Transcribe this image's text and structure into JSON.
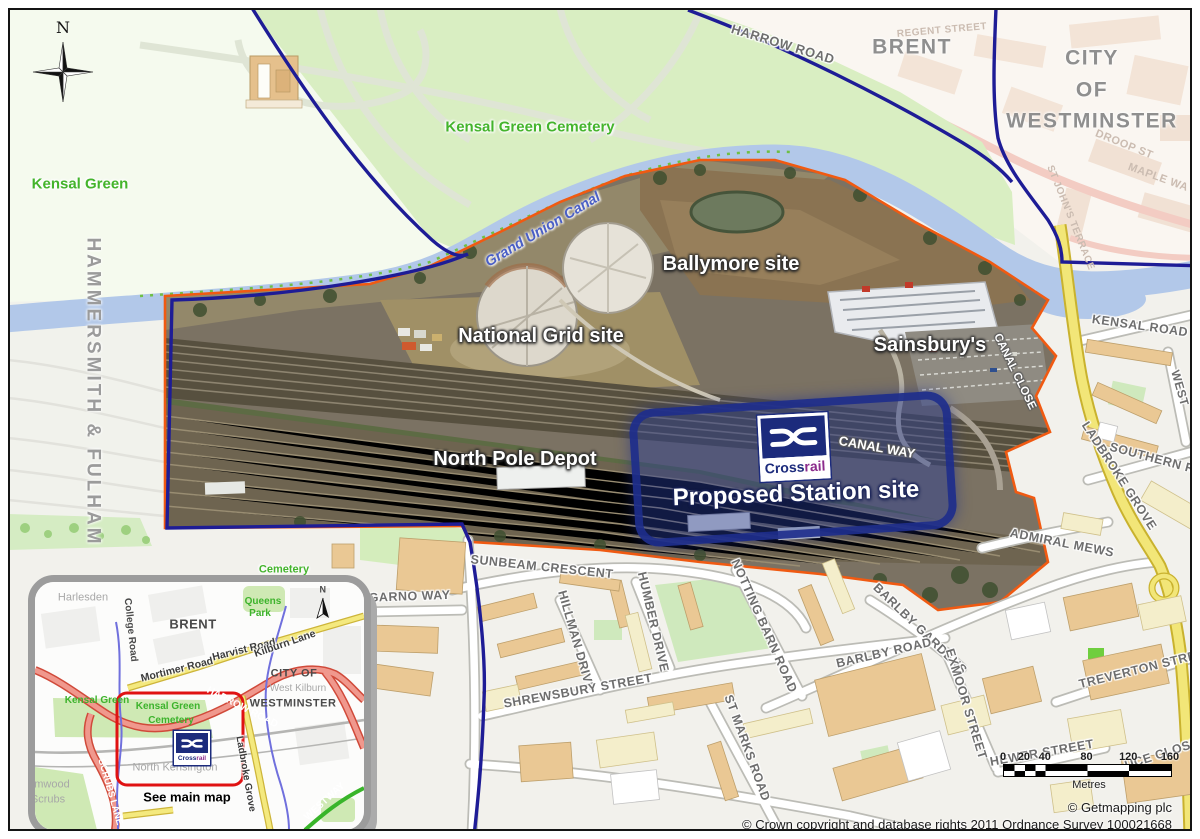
{
  "map": {
    "north_indicator": "N",
    "overlay": {
      "title": "Proposed Station site",
      "road": "CANAL WAY",
      "logo_text_1": "Cross",
      "logo_text_2": "rail"
    },
    "labels": [
      {
        "id": "kensal-green",
        "t": "Kensal Green",
        "x": 80,
        "y": 184,
        "r": 0,
        "s": 15,
        "c": "green"
      },
      {
        "id": "hammersmith-fulham",
        "t": "HAMMERSMITH & FULHAM",
        "x": 93,
        "y": 392,
        "r": 90,
        "s": 19,
        "c": "borough sp"
      },
      {
        "id": "kensal-green-cemetery",
        "t": "Kensal Green Cemetery",
        "x": 530,
        "y": 127,
        "r": 0,
        "s": 15,
        "c": "green"
      },
      {
        "id": "grand-union-canal",
        "t": "Grand Union Canal",
        "x": 543,
        "y": 230,
        "r": -31,
        "s": 14.5,
        "c": "canal"
      },
      {
        "id": "harrow-road",
        "t": "HARROW ROAD",
        "x": 783,
        "y": 44,
        "r": 17,
        "s": 13,
        "c": "street"
      },
      {
        "id": "brent",
        "t": "BRENT",
        "x": 912,
        "y": 47,
        "r": 0,
        "s": 21,
        "c": "borough"
      },
      {
        "id": "regent-street",
        "t": "REGENT STREET",
        "x": 942,
        "y": 31,
        "r": -5,
        "s": 10,
        "c": "faint"
      },
      {
        "id": "city",
        "t": "CITY",
        "x": 1092,
        "y": 58,
        "r": 0,
        "s": 21,
        "c": "borough"
      },
      {
        "id": "of",
        "t": "OF",
        "x": 1092,
        "y": 90,
        "r": 0,
        "s": 21,
        "c": "borough"
      },
      {
        "id": "westminster",
        "t": "WESTMINSTER",
        "x": 1092,
        "y": 121,
        "r": 0,
        "s": 21,
        "c": "borough"
      },
      {
        "id": "droop-st",
        "t": "DROOP ST",
        "x": 1124,
        "y": 145,
        "r": 22,
        "s": 11,
        "c": "faint"
      },
      {
        "id": "maple-wa",
        "t": "MAPLE WA",
        "x": 1158,
        "y": 178,
        "r": 20,
        "s": 11,
        "c": "faint"
      },
      {
        "id": "st-johns-terrace",
        "t": "ST JOHN'S TERRACE",
        "x": 1070,
        "y": 218,
        "r": 68,
        "s": 10,
        "c": "faint"
      },
      {
        "id": "ballymore-site",
        "t": "Ballymore site",
        "x": 731,
        "y": 264,
        "r": 0,
        "s": 20,
        "c": "site"
      },
      {
        "id": "national-grid-site",
        "t": "National Grid site",
        "x": 541,
        "y": 336,
        "r": 0,
        "s": 20,
        "c": "site"
      },
      {
        "id": "sainsburys",
        "t": "Sainsbury's",
        "x": 930,
        "y": 345,
        "r": 0,
        "s": 20,
        "c": "site"
      },
      {
        "id": "canal-close",
        "t": "CANAL CLOSE",
        "x": 1014,
        "y": 372,
        "r": 64,
        "s": 11.5,
        "c": "whiteroad"
      },
      {
        "id": "north-pole-depot",
        "t": "North Pole Depot",
        "x": 515,
        "y": 459,
        "r": 0,
        "s": 20,
        "c": "site"
      },
      {
        "id": "canal-way",
        "t": "CANAL WAY",
        "x": 877,
        "y": 447,
        "r": 10,
        "s": 13,
        "c": "whiteroad"
      },
      {
        "id": "proposed-station-site",
        "t": "Proposed Station site",
        "x": 796,
        "y": 494,
        "r": -2,
        "s": 24,
        "c": "site big"
      },
      {
        "id": "kensal-road",
        "t": "KENSAL ROAD",
        "x": 1140,
        "y": 326,
        "r": 8,
        "s": 12.5,
        "c": "street"
      },
      {
        "id": "west",
        "t": "WEST",
        "x": 1180,
        "y": 388,
        "r": 74,
        "s": 12,
        "c": "street"
      },
      {
        "id": "southern-row",
        "t": "SOUTHERN ROW",
        "x": 1163,
        "y": 461,
        "r": 15,
        "s": 12.5,
        "c": "street"
      },
      {
        "id": "ladbroke-grove",
        "t": "LADBROKE GROVE",
        "x": 1119,
        "y": 476,
        "r": 57,
        "s": 12.5,
        "c": "street"
      },
      {
        "id": "admiral-mews",
        "t": "ADMIRAL MEWS",
        "x": 1062,
        "y": 543,
        "r": 11,
        "s": 12.5,
        "c": "street"
      },
      {
        "id": "sunbeam-crescent",
        "t": "SUNBEAM CRESCENT",
        "x": 542,
        "y": 567,
        "r": 6,
        "s": 12.5,
        "c": "street"
      },
      {
        "id": "dalgarno-way",
        "t": "DALGARNO WAY",
        "x": 396,
        "y": 597,
        "r": -2,
        "s": 12.5,
        "c": "street"
      },
      {
        "id": "hillman-drive",
        "t": "HILLMAN DRIVE",
        "x": 576,
        "y": 641,
        "r": 74,
        "s": 12.5,
        "c": "street"
      },
      {
        "id": "humber-drive",
        "t": "HUMBER DRIVE",
        "x": 653,
        "y": 622,
        "r": 77,
        "s": 12.5,
        "c": "street"
      },
      {
        "id": "notting-barn-road",
        "t": "NOTTING BARN ROAD",
        "x": 764,
        "y": 626,
        "r": 66,
        "s": 12.5,
        "c": "street"
      },
      {
        "id": "shrewsbury-street",
        "t": "SHREWSBURY STREET",
        "x": 578,
        "y": 691,
        "r": -10,
        "s": 12.5,
        "c": "street"
      },
      {
        "id": "st-marks-road",
        "t": "ST MARKS ROAD",
        "x": 747,
        "y": 748,
        "r": 70,
        "s": 12.5,
        "c": "street"
      },
      {
        "id": "barlby-gardens",
        "t": "BARLBY GARDENS",
        "x": 920,
        "y": 629,
        "r": 44,
        "s": 12.5,
        "c": "street"
      },
      {
        "id": "barlby-road",
        "t": "BARLBY ROAD",
        "x": 884,
        "y": 653,
        "r": -13,
        "s": 12.5,
        "c": "street"
      },
      {
        "id": "exmoor-street",
        "t": "EXMOOR STREET",
        "x": 966,
        "y": 704,
        "r": 73,
        "s": 12.5,
        "c": "street"
      },
      {
        "id": "treverton-street",
        "t": "TREVERTON STREET",
        "x": 1146,
        "y": 668,
        "r": -14,
        "s": 12.5,
        "c": "street"
      },
      {
        "id": "hewer-street",
        "t": "HEWER STREET",
        "x": 1042,
        "y": 753,
        "r": -10,
        "s": 12.5,
        "c": "street"
      },
      {
        "id": "uce-close",
        "t": "UCE CLOSE",
        "x": 1162,
        "y": 754,
        "r": -18,
        "s": 12.5,
        "c": "street"
      },
      {
        "id": "cemetery-top",
        "t": "Cemetery",
        "x": 284,
        "y": 570,
        "r": 0,
        "s": 11,
        "c": "green small"
      }
    ],
    "inset": {
      "logo_text_1": "Cross",
      "logo_text_2": "rail",
      "north_indicator": "N",
      "labels": [
        {
          "id": "harlesden",
          "t": "Harlesden",
          "x": 48,
          "y": 16,
          "r": 0,
          "s": 11,
          "c": "igray"
        },
        {
          "id": "college-road",
          "t": "College Road",
          "x": 95,
          "y": 48,
          "r": 84,
          "s": 10,
          "c": "idark"
        },
        {
          "id": "brent",
          "t": "BRENT",
          "x": 158,
          "y": 42,
          "r": 0,
          "s": 13,
          "c": "ibold"
        },
        {
          "id": "queens",
          "t": "Queens",
          "x": 228,
          "y": 20,
          "r": 0,
          "s": 10,
          "c": "igreen"
        },
        {
          "id": "park",
          "t": "Park",
          "x": 225,
          "y": 32,
          "r": 0,
          "s": 10,
          "c": "igreen"
        },
        {
          "id": "mortimer-road",
          "t": "Mortimer Road",
          "x": 142,
          "y": 88,
          "r": -14,
          "s": 10.5,
          "c": "iroad"
        },
        {
          "id": "harvist-road",
          "t": "Harvist Road",
          "x": 209,
          "y": 68,
          "r": -14,
          "s": 10.5,
          "c": "iroad"
        },
        {
          "id": "kilburn-lane",
          "t": "Kilburn Lane",
          "x": 250,
          "y": 62,
          "r": -19,
          "s": 10.5,
          "c": "iroad"
        },
        {
          "id": "city-of",
          "t": "CITY OF",
          "x": 259,
          "y": 92,
          "r": 0,
          "s": 11,
          "c": "ibold"
        },
        {
          "id": "west-kilburn",
          "t": "West Kilburn",
          "x": 263,
          "y": 107,
          "r": 0,
          "s": 10,
          "c": "igray"
        },
        {
          "id": "westminster",
          "t": "WESTMINSTER",
          "x": 258,
          "y": 122,
          "r": 0,
          "s": 11,
          "c": "ibold"
        },
        {
          "id": "kensal-green",
          "t": "Kensal Green",
          "x": 62,
          "y": 119,
          "r": 0,
          "s": 10,
          "c": "igreen"
        },
        {
          "id": "kg-cemetery-1",
          "t": "Kensal Green",
          "x": 133,
          "y": 125,
          "r": 0,
          "s": 10,
          "c": "igreen"
        },
        {
          "id": "kg-cemetery-2",
          "t": "Cemetery",
          "x": 136,
          "y": 139,
          "r": 0,
          "s": 10,
          "c": "igreen"
        },
        {
          "id": "harrow-road",
          "t": "HARROW ROAD",
          "x": 207,
          "y": 126,
          "r": 27,
          "s": 10,
          "c": "iwhite"
        },
        {
          "id": "north-kensington",
          "t": "North Kensington",
          "x": 140,
          "y": 186,
          "r": 0,
          "s": 11,
          "c": "igray"
        },
        {
          "id": "see-main-map",
          "t": "See main map",
          "x": 152,
          "y": 215,
          "r": 0,
          "s": 13,
          "c": "iblack"
        },
        {
          "id": "scrubs-lane",
          "t": "SCRUBS LANE",
          "x": 75,
          "y": 210,
          "r": 74,
          "s": 9.5,
          "c": "iwhite"
        },
        {
          "id": "wormwood",
          "t": "Wormwood",
          "x": 7,
          "y": 203,
          "r": 0,
          "s": 11,
          "c": "igray"
        },
        {
          "id": "scrubs",
          "t": "Scrubs",
          "x": 13,
          "y": 218,
          "r": 0,
          "s": 11,
          "c": "igray"
        },
        {
          "id": "ladbroke-grove",
          "t": "Ladbroke Grove",
          "x": 210,
          "y": 192,
          "r": 80,
          "s": 10,
          "c": "iroad"
        },
        {
          "id": "westway",
          "t": "WESTWAY",
          "x": 290,
          "y": 220,
          "r": -42,
          "s": 10,
          "c": "iwhite"
        },
        {
          "id": "north",
          "t": "N",
          "x": 288,
          "y": 8,
          "r": 0,
          "s": 9,
          "c": "ibold"
        }
      ]
    },
    "scale_bar": {
      "ticks": [
        "0",
        "20",
        "40",
        "80",
        "120",
        "160"
      ],
      "values": [
        0,
        20,
        40,
        80,
        120,
        160
      ],
      "max": 160,
      "length_px": 167,
      "unit": "Metres"
    },
    "credits": {
      "getmapping": "© Getmapping plc",
      "os": "© Crown copyright and database rights 2011 Ordnance Survey 100021668"
    },
    "colors": {
      "boundary_navy": "#1e1c96",
      "site_outline_orange": "#f05a12",
      "canal_blue": "#b2c8e9",
      "cemetery_green": "#d9eec2",
      "overlay_blue": "#26329a",
      "crossrail_navy": "#1c2b7c",
      "crossrail_purple": "#8c2c8c"
    }
  }
}
